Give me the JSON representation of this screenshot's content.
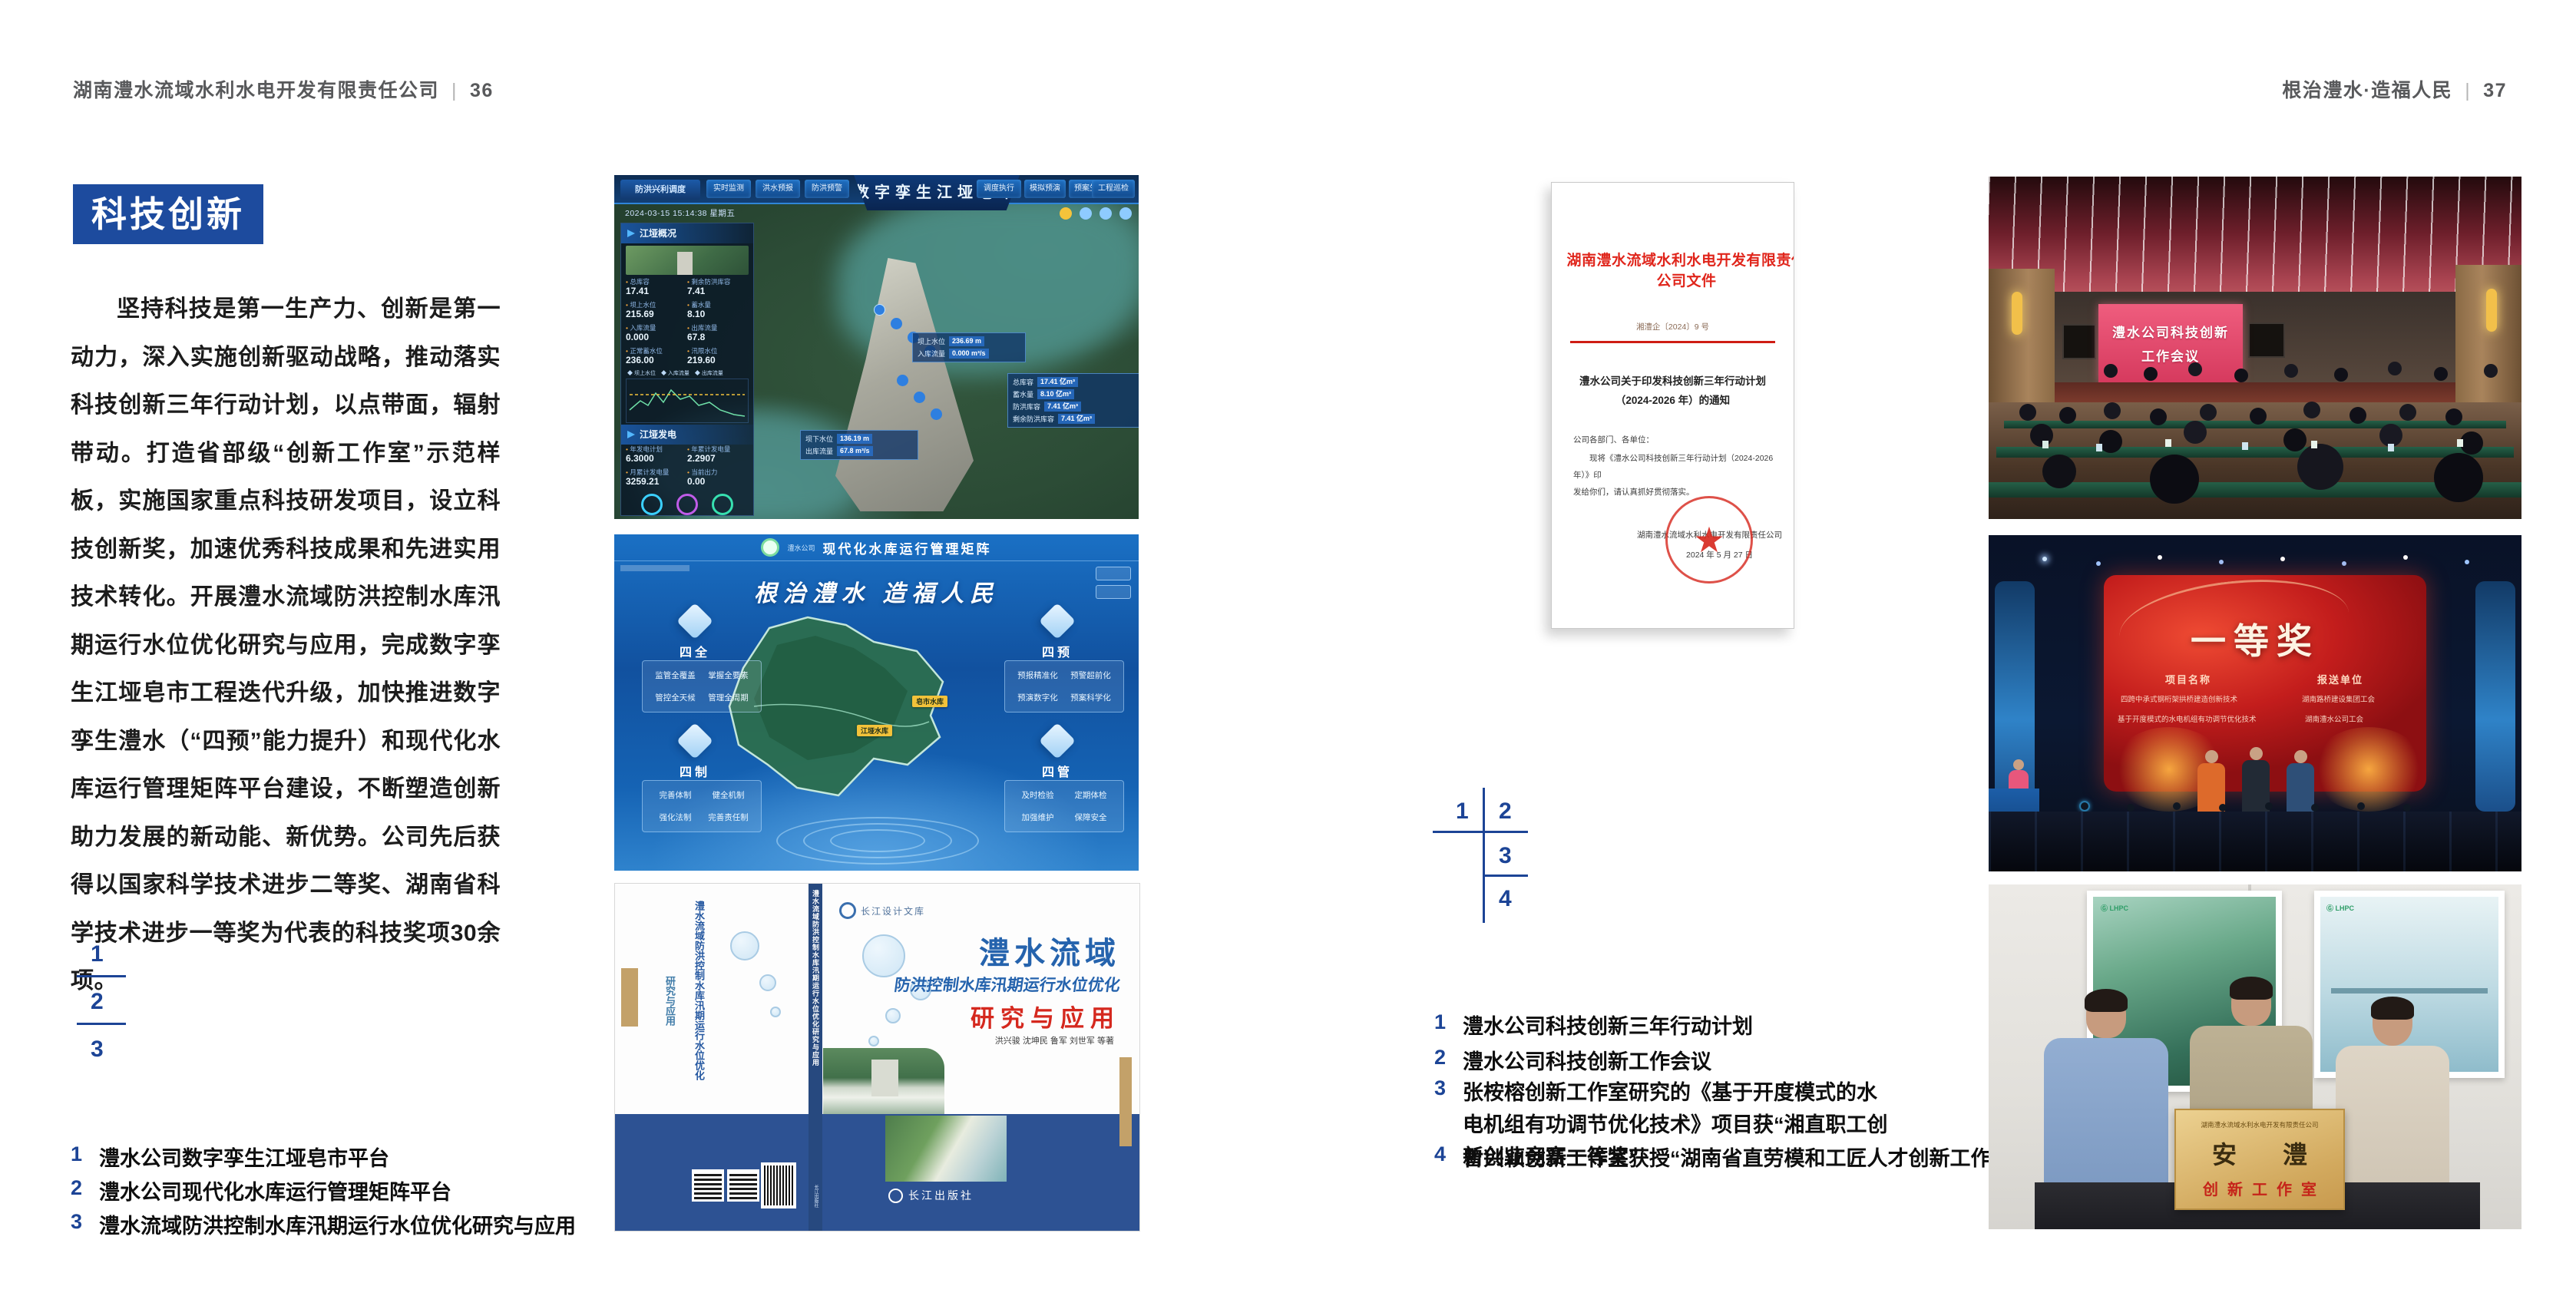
{
  "left": {
    "header": {
      "company": "湖南澧水流域水利水电开发有限责任公司",
      "divider": "|",
      "page": "36"
    },
    "badge": "科技创新",
    "paragraph": "坚持科技是第一生产力、创新是第一动力，深入实施创新驱动战略，推动落实科技创新三年行动计划，以点带面，辐射带动。打造省部级“创新工作室”示范样板，实施国家重点科技研发项目，设立科技创新奖，加速优秀科技成果和先进实用技术转化。开展澧水流域防洪控制水库汛期运行水位优化研究与应用，完成数字孪生江垭皂市工程迭代升级，加快推进数字孪生澧水（“四预”能力提升）和现代化水库运行管理矩阵平台建设，不断塑造创新助力发展的新动能、新优势。公司先后获得以国家科学技术进步二等奖、湖南省科学技术进步一等奖为代表的科技奖项30余项。",
    "figure_nums": {
      "n1": "1",
      "n2": "2",
      "n3": "3"
    },
    "captions": [
      {
        "num": "1",
        "text": "澧水公司数字孪生江垭皂市平台"
      },
      {
        "num": "2",
        "text": "澧水公司现代化水库运行管理矩阵平台"
      },
      {
        "num": "3",
        "text": "澧水流域防洪控制水库汛期运行水位优化研究与应用"
      }
    ]
  },
  "right": {
    "header": {
      "title": "根治澧水·造福人民",
      "divider": "|",
      "page": "37"
    },
    "figure_nums": {
      "n1": "1",
      "n2": "2",
      "n3": "3",
      "n4": "4"
    },
    "captions": [
      {
        "num": "1",
        "text": "澧水公司科技创新三年行动计划"
      },
      {
        "num": "2",
        "text": "澧水公司科技创新工作会议"
      },
      {
        "num": "3",
        "text": "张桉榕创新工作室研究的《基于开度模式的水电机组有功调节优化技术》项目获“湘直职工创新创业竞赛一等奖”"
      },
      {
        "num": "4",
        "text": "曾兴颖创新工作室获授“湖南省直劳模和工匠人才创新工作室”"
      }
    ]
  },
  "twin": {
    "module": "防洪兴利调度",
    "title": "数字孪生江垭皂市",
    "tabs_left": [
      "实时监测",
      "洪水预报",
      "防洪预警"
    ],
    "tabs_right": [
      "模拟预演",
      "预案生成",
      "调度执行",
      "工程巡检"
    ],
    "timestamp": "2024-03-15 15:14:38 星期五",
    "panel_overview": "江垭概况",
    "panel_power": "江垭发电",
    "stats": [
      {
        "label": "总库容",
        "value": "17.41"
      },
      {
        "label": "剩余防洪库容",
        "value": "7.41"
      },
      {
        "label": "坝上水位",
        "value": "215.69"
      },
      {
        "label": "蓄水量",
        "value": "8.10"
      },
      {
        "label": "入库流量",
        "value": "0.000"
      },
      {
        "label": "出库流量",
        "value": "67.8"
      },
      {
        "label": "正常蓄水位",
        "value": "236.00"
      },
      {
        "label": "汛限水位",
        "value": "219.60"
      }
    ],
    "legend": "◆ 坝上水位　◆ 入库流量　◆ 出库流量",
    "power_stats": [
      {
        "label": "年发电计划",
        "value": "6.3000"
      },
      {
        "label": "年累计发电量",
        "value": "2.2907"
      },
      {
        "label": "月累计发电量",
        "value": "3259.21"
      },
      {
        "label": "当前出力",
        "value": "0.00"
      }
    ],
    "callout1": {
      "l1": "坝上水位",
      "v1": "236.69 m",
      "l2": "入库流量",
      "v2": "0.000 m³/s"
    },
    "callout2": [
      {
        "label": "总库容",
        "value": "17.41 亿m³"
      },
      {
        "label": "蓄水量",
        "value": "8.10 亿m³"
      },
      {
        "label": "防洪库容",
        "value": "7.41 亿m³"
      },
      {
        "label": "剩余防洪库容",
        "value": "7.41 亿m³"
      }
    ],
    "callout3": {
      "l1": "坝下水位",
      "v1": "136.19 m",
      "l2": "出库流量",
      "v2": "67.8 m³/s"
    }
  },
  "matrix": {
    "logo_text": "澧水公司",
    "title": "现代化水库运行管理矩阵",
    "slogan": "根治澧水  造福人民",
    "q1": {
      "name": "四全",
      "items": [
        "监管全覆盖",
        "掌握全要素",
        "管控全天候",
        "管理全周期"
      ]
    },
    "q2": {
      "name": "四预",
      "items": [
        "预报精准化",
        "预警超前化",
        "预演数字化",
        "预案科学化"
      ]
    },
    "q3": {
      "name": "四制",
      "items": [
        "完善体制",
        "健全机制",
        "强化法制",
        "完善责任制"
      ]
    },
    "q4": {
      "name": "四管",
      "items": [
        "及时检验",
        "定期体检",
        "加强维护",
        "保障安全"
      ]
    },
    "label1": "皂市水库",
    "label2": "江垭水库"
  },
  "book": {
    "brand": "长江设计文库",
    "t1": "澧水流域",
    "t2": "防洪控制水库汛期运行水位优化",
    "t3": "研究与应用",
    "authors": "洪兴骏  沈坤民  鲁军  刘世军  等著",
    "publisher": "长江出版社",
    "spine": "澧水流域防洪控制水库汛期运行水位优化研究与应用",
    "back_t1": "澧水流域防洪控制水库汛期运行水位优化",
    "back_t3": "研究与应用"
  },
  "doc": {
    "title": "湖南澧水流域水利水电开发有限责任公司文件",
    "number": "湘澧企〔2024〕9 号",
    "subject1": "澧水公司关于印发科技创新三年行动计划",
    "subject2": "（2024-2026 年）的通知",
    "salutation": "公司各部门、各单位：",
    "body1": "现将《澧水公司科技创新三年行动计划（2024-2026 年）》印",
    "body2": "发给你们，请认真抓好贯彻落实。",
    "signer": "湖南澧水流域水利水电开发有限责任公司",
    "date": "2024 年 5 月 27 日",
    "seal_star": "★"
  },
  "meeting": {
    "screen1": "澧水公司科技创新",
    "screen2": "工作会议"
  },
  "award": {
    "title": "一等奖",
    "col1": "项目名称",
    "col2": "报送单位",
    "p1": "四跨中承式钢桁架拱桥建造创新技术",
    "u1": "湖南路桥建设集团工会",
    "p2": "基于开度模式的水电机组有功调节优化技术",
    "u2": "湖南澧水公司工会"
  },
  "plaque": {
    "org": "湖南澧水流域水利水电开发有限责任公司",
    "name": "安 澧",
    "subtitle": "创新工作室"
  },
  "colors": {
    "accent_blue": "#1d4b9e",
    "doc_red": "#e0251b",
    "band_blue": "#2d5293"
  }
}
